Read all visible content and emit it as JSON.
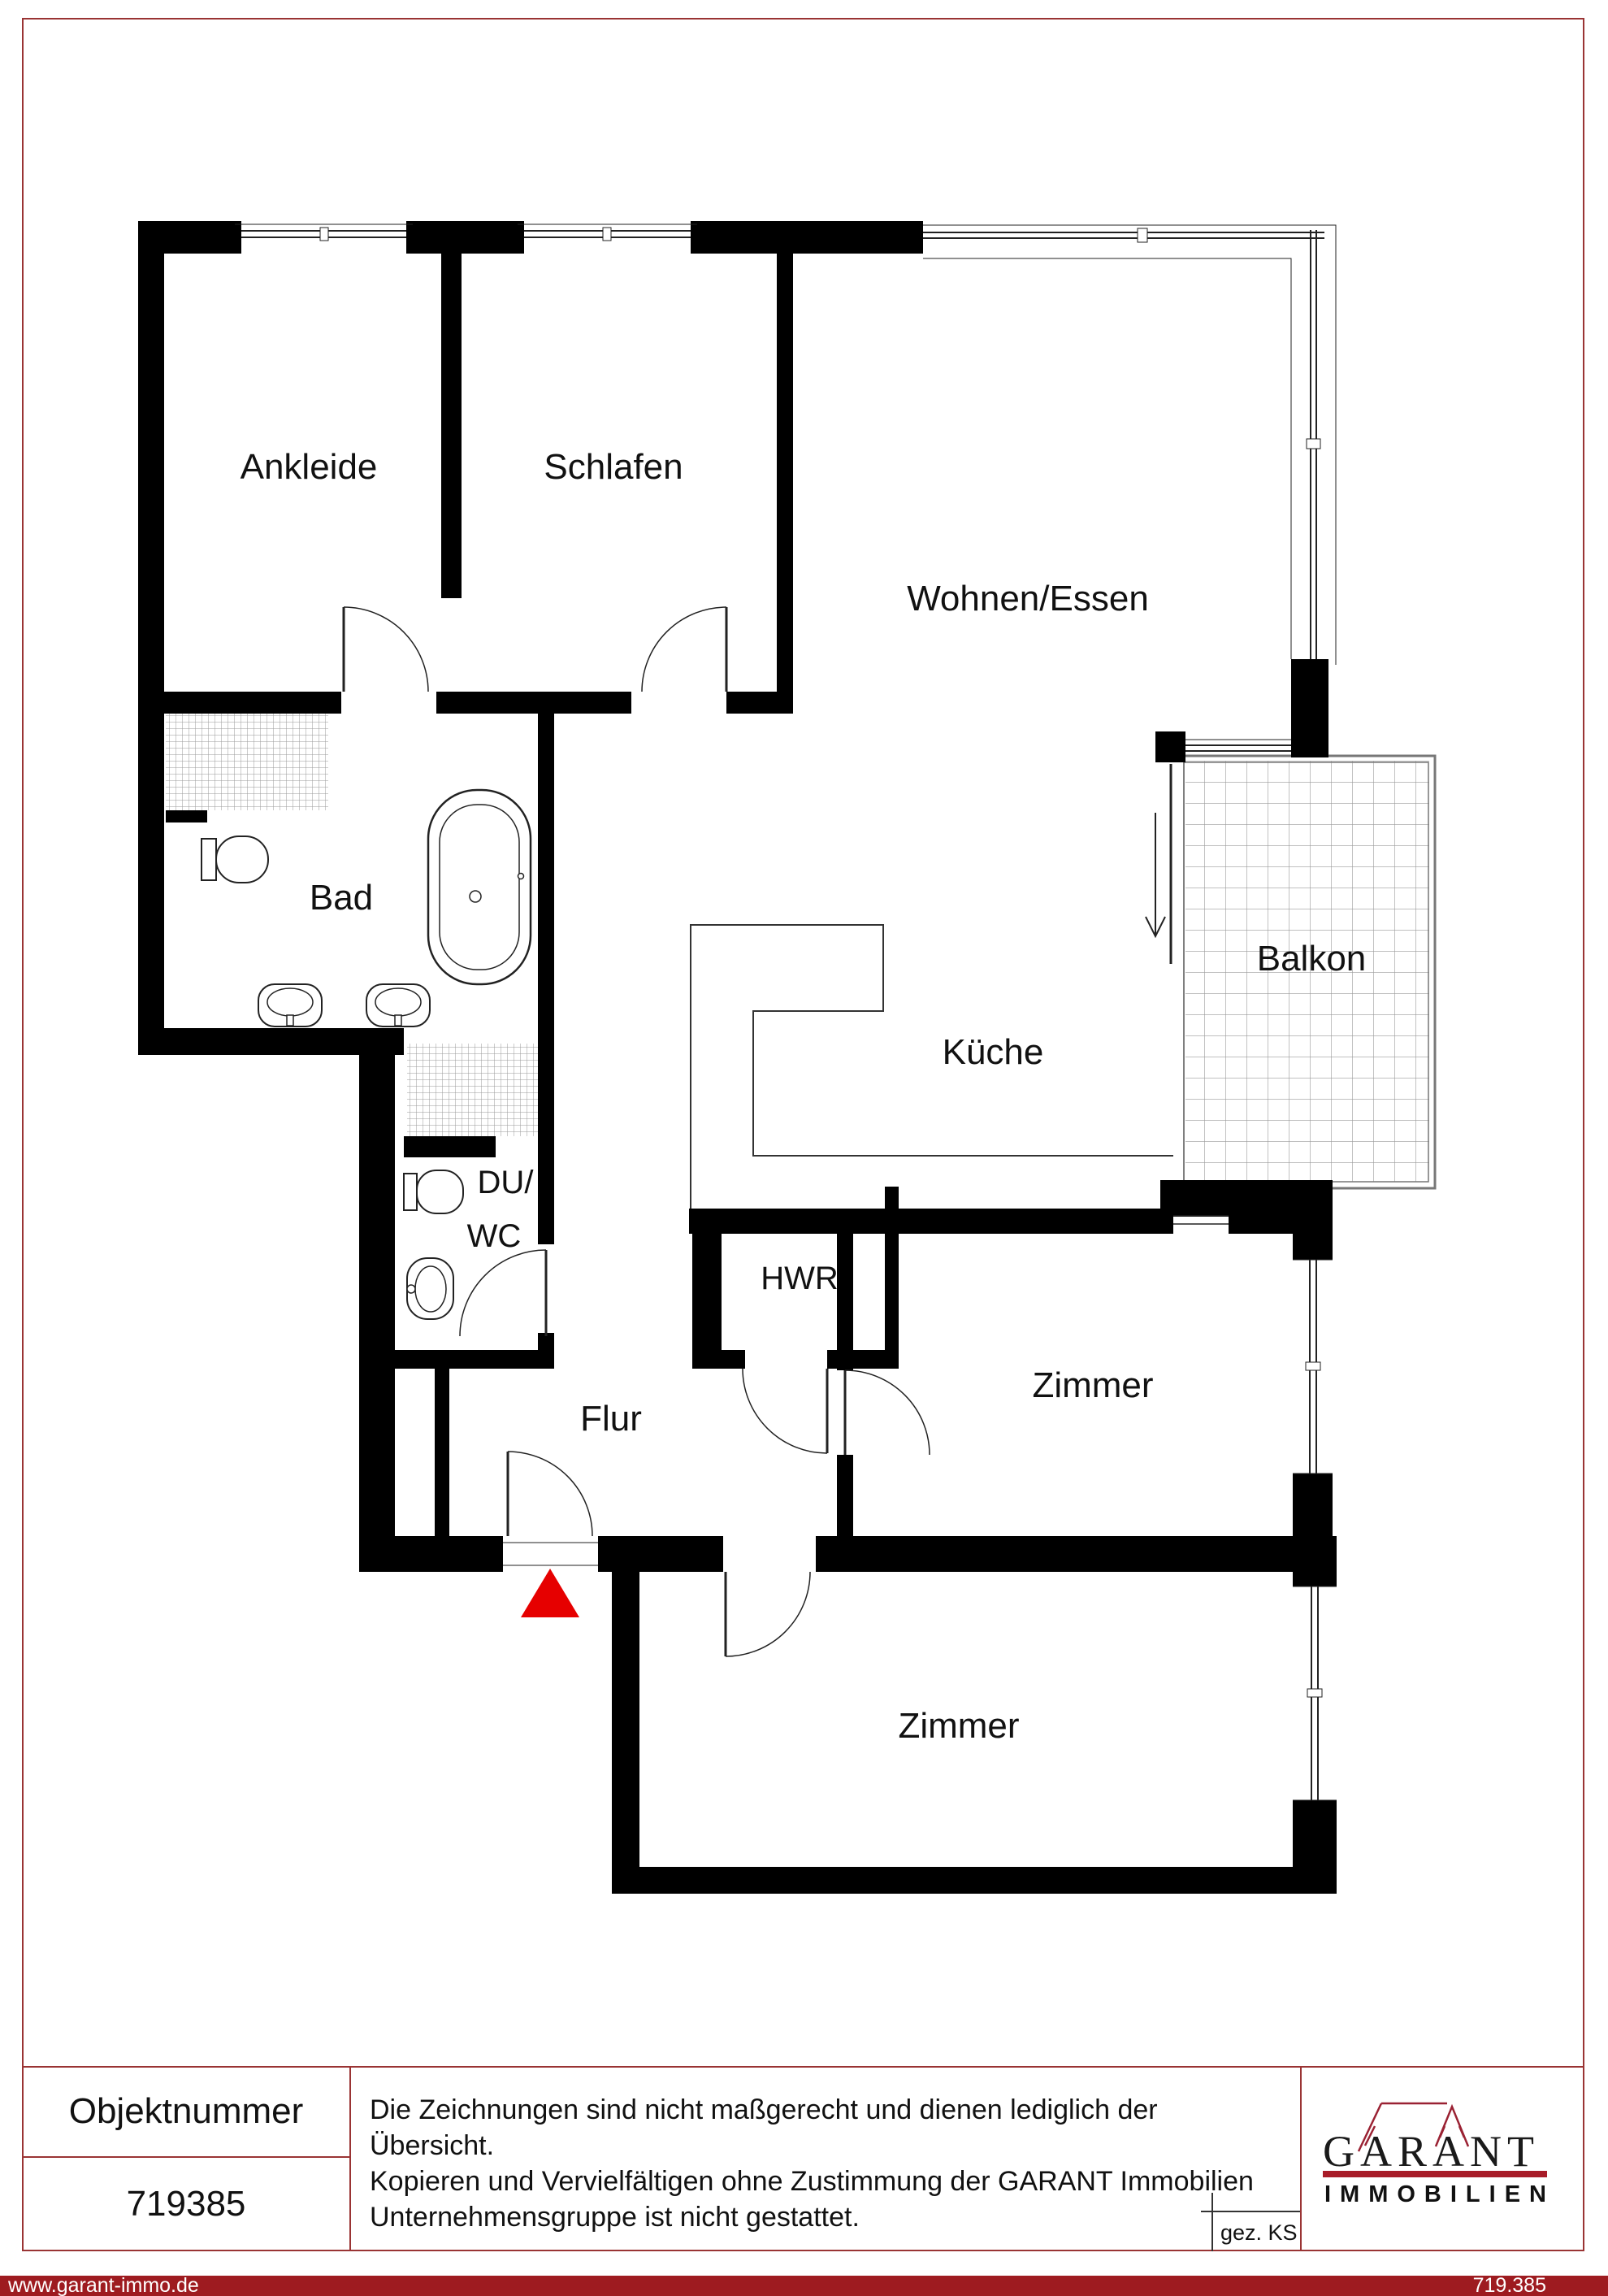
{
  "page": {
    "border_color": "#9a3434",
    "background": "#ffffff"
  },
  "floorplan": {
    "labels": {
      "ankleide": "Ankleide",
      "schlafen": "Schlafen",
      "wohnen_essen": "Wohnen/Essen",
      "bad": "Bad",
      "kueche": "Küche",
      "balkon": "Balkon",
      "du": "DU/",
      "wc": "WC",
      "hwr": "HWR",
      "flur": "Flur",
      "zimmer_mitte": "Zimmer",
      "zimmer_unten": "Zimmer"
    },
    "colors": {
      "wall": "#000000",
      "hatch_line": "#9a9a9a",
      "balcony_grid": "#9a9a9a",
      "railing": "#777777",
      "door_line": "#222222",
      "entrance_marker": "#e60000"
    }
  },
  "footer": {
    "object_number_label": "Objektnummer",
    "object_number": "719385",
    "disclaimer_lines": [
      "Die Zeichnungen sind nicht maßgerecht und dienen lediglich der Übersicht.",
      "Kopieren und Vervielfältigen ohne Zustimmung der GARANT Immobilien",
      "Unternehmensgruppe ist nicht gestattet."
    ],
    "signed_label": "gez. KS",
    "logo": {
      "name": "GARANT",
      "subtitle": "IMMOBILIEN",
      "accent": "#a81c28",
      "roof_color": "#9a2233"
    }
  },
  "bottom_bar": {
    "left_text": "www.garant-immo.de",
    "right_text": "719.385",
    "background": "#9e1b20"
  }
}
